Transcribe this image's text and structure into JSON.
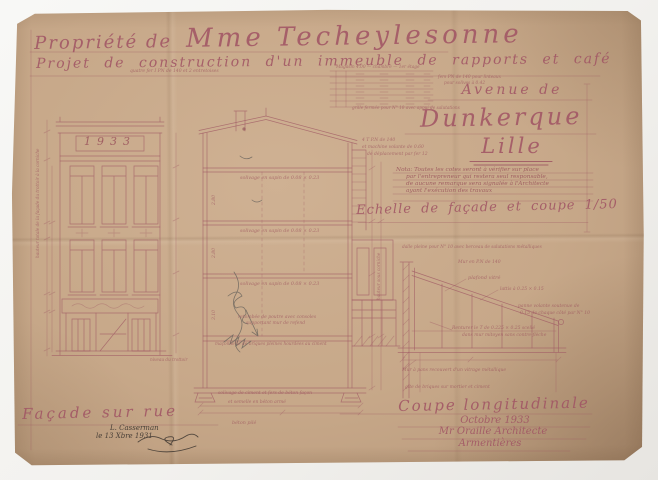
{
  "titles": {
    "property_prefix": "Propriété de",
    "property_owner": "Mme Techeylesonne",
    "project_line": "Projet de construction d'un immeuble de rapports et café",
    "avenue_line": "Avenue de",
    "street_name": "Dunkerque",
    "city": "Lille",
    "scale_caption": "Echelle de façade et coupe 1/50"
  },
  "nota": {
    "lines": [
      "Nota: Toutes les cotes seront à vérifier sur place",
      "par l'entrepreneur qui restera seul responsable,",
      "de aucune remarque sera signalée à l'Architecte",
      "ayant l'exécution des travaux"
    ]
  },
  "facade": {
    "caption": "Façade sur rue",
    "year_panel": "1933",
    "signature_lines": [
      "L. Casserman",
      "le 13 Xbre 1931"
    ]
  },
  "section": {
    "caption": "Coupe longitudinale",
    "date": "Octobre 1933",
    "architect": "Mr Oraille Architecte",
    "city": "Armentières"
  },
  "annotations": [
    {
      "t": "quatre fer I PN de 140 et 2 entretoises",
      "x": 130,
      "y": 69,
      "s": 4.5
    },
    {
      "t": "Magasin 4.00 — chambre — 1er étage",
      "x": 336,
      "y": 66,
      "s": 4.3
    },
    {
      "t": "fers PN de 140 pour linteaux",
      "x": 438,
      "y": 76,
      "s": 4.3
    },
    {
      "t": "pour solives à 0.42",
      "x": 444,
      "y": 82,
      "s": 4.3
    },
    {
      "t": "grille fermée pour N° 10 avec appui de salutations",
      "x": 352,
      "y": 106,
      "s": 4.2,
      "w": 150
    },
    {
      "t": "4 T P.N de 140",
      "x": 362,
      "y": 138,
      "s": 4.5
    },
    {
      "t": "et machine volante de 0.60",
      "x": 362,
      "y": 145,
      "s": 4.5
    },
    {
      "t": "de déplacement par fer 12",
      "x": 367,
      "y": 152,
      "s": 4.5
    },
    {
      "t": "dalle pleine pour N° 10 avec berceau de salutations métalliques",
      "x": 402,
      "y": 246,
      "s": 4.3,
      "w": 195
    },
    {
      "t": "Mur en P.N de 140",
      "x": 458,
      "y": 260,
      "s": 4.5
    },
    {
      "t": "plafond vitré",
      "x": 468,
      "y": 276,
      "s": 5
    },
    {
      "t": "lattis à 0.25 × 0.15",
      "x": 500,
      "y": 287,
      "s": 4.5
    },
    {
      "t": "panne volante soutenue de",
      "x": 518,
      "y": 304,
      "s": 4.5
    },
    {
      "t": "0.15 de chaque côté par N° 10",
      "x": 520,
      "y": 311,
      "s": 4.5
    },
    {
      "t": "Renturer le T de 0.225 × 0.25 scellé",
      "x": 452,
      "y": 326,
      "s": 4.5
    },
    {
      "t": "dans mur mitoyen sans contre-flèche",
      "x": 462,
      "y": 333,
      "s": 4.5
    },
    {
      "t": "Mur à pans recouvert d'un vitrage métallique",
      "x": 402,
      "y": 368,
      "s": 4.5,
      "w": 185
    },
    {
      "t": "gîte de briques sur mortier et ciment",
      "x": 405,
      "y": 385,
      "s": 4.5,
      "w": 175
    },
    {
      "t": "solivage en sapin de 0.08 × 0.23",
      "x": 240,
      "y": 176,
      "s": 4.8
    },
    {
      "t": "solivage en sapin de 0.08 × 0.23",
      "x": 240,
      "y": 229,
      "s": 4.8
    },
    {
      "t": "solivage en sapin de 0.08 × 0.23",
      "x": 240,
      "y": 282,
      "s": 4.8
    },
    {
      "t": "retombée de poutre avec consoles",
      "x": 238,
      "y": 315,
      "s": 4.5
    },
    {
      "t": "supportant mur de refend",
      "x": 246,
      "y": 321,
      "s": 4.5
    },
    {
      "t": "maçonnerie de briques pleines hourdées au ciment",
      "x": 215,
      "y": 343,
      "s": 4.3,
      "w": 185
    },
    {
      "t": "solivage de ciment et fers de béton façon",
      "x": 218,
      "y": 391,
      "s": 4.5,
      "w": 175
    },
    {
      "t": "et semelle en béton armé",
      "x": 228,
      "y": 400,
      "s": 4.5
    },
    {
      "t": "béton pilé",
      "x": 232,
      "y": 421,
      "s": 4.8
    },
    {
      "t": "niveau du trottoir",
      "x": 150,
      "y": 358,
      "s": 4.2
    },
    {
      "t": "hauteur totale de la façade du trottoir à la corniche",
      "x": 36,
      "y": 258,
      "s": 4.2,
      "r": -90
    },
    {
      "t": "hauteur sous corniche",
      "x": 377,
      "y": 300,
      "s": 4.2,
      "r": -90
    },
    {
      "t": "2.80",
      "x": 212,
      "y": 205,
      "s": 4.5,
      "r": -90
    },
    {
      "t": "2.80",
      "x": 212,
      "y": 258,
      "s": 4.5,
      "r": -90
    },
    {
      "t": "3.10",
      "x": 212,
      "y": 320,
      "s": 4.5,
      "r": -90
    }
  ],
  "colors": {
    "paper": "#c7a889",
    "ink": "#a05a64",
    "ink_strong": "#8e4352",
    "pencil": "#6f675f",
    "signature": "#4a4038",
    "scan_background": "#f4f4f2"
  }
}
